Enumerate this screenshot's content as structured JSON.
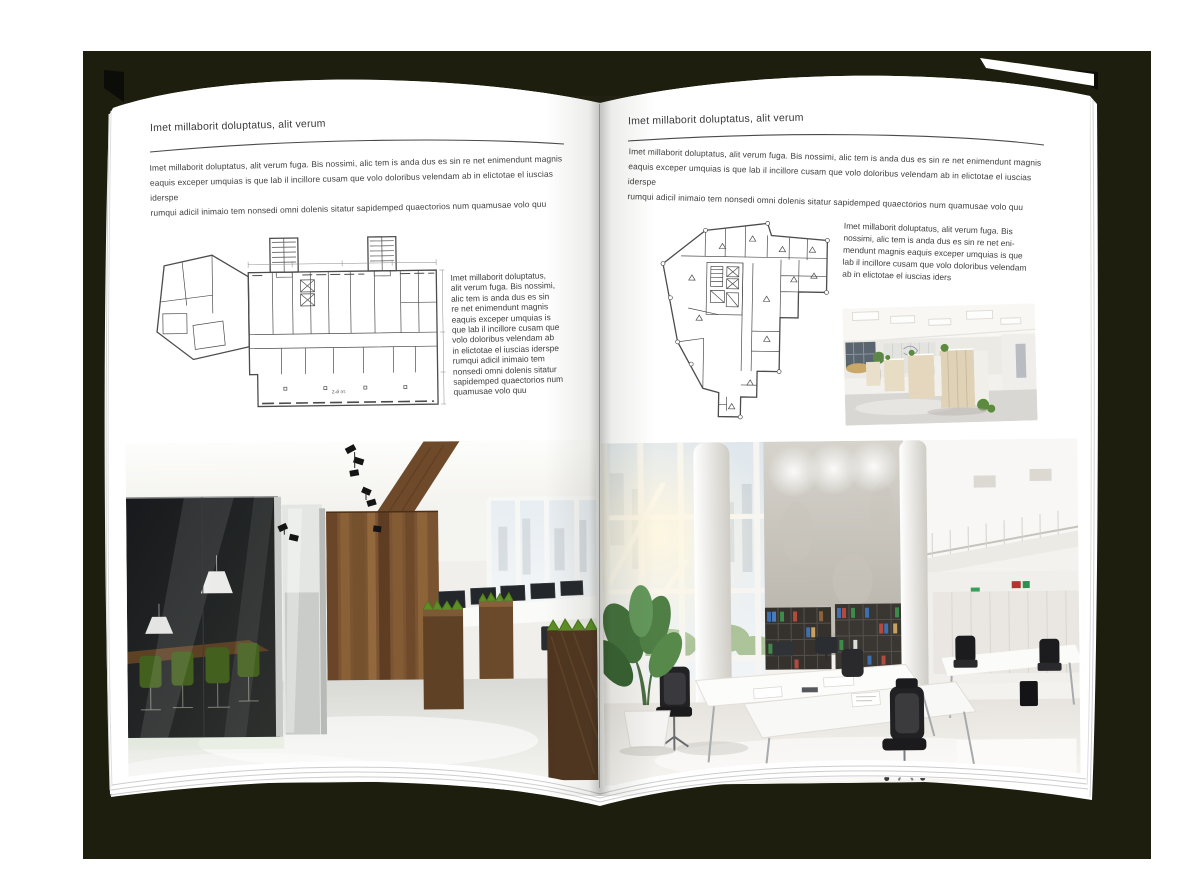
{
  "canvas": {
    "backdrop_color": "#1d1e0e",
    "page_color": "#ffffff"
  },
  "left_page": {
    "header": "Imet millaborit doluptatus, alit verum",
    "intro_lines": [
      "Imet millaborit doluptatus, alit verum fuga. Bis nossimi, alic tem is anda dus es sin re net enimendunt magnis",
      "eaquis exceper umquias is que lab il incillore cusam que volo doloribus velendam ab in elictotae el iuscias iderspe",
      "rumqui adicil inimaio tem nonsedi omni dolenis sitatur sapidemped quaectorios num quamusae volo quu"
    ],
    "side_text_lines": [
      "Imet millaborit doluptatus,",
      "alit verum fuga. Bis nossimi,",
      "alic tem is anda dus es sin",
      "re net enimendunt magnis",
      "eaquis exceper umquias is",
      "que lab il incillore cusam que",
      "volo doloribus velendam ab",
      "in elictotae el iuscias iderspe",
      "rumqui adicil inimaio tem",
      "nonsedi omni dolenis sitatur",
      "sapidemped quaectorios num",
      "quamusae volo quu"
    ],
    "plan_label": "2-й эт."
  },
  "right_page": {
    "header": "Imet millaborit doluptatus, alit verum",
    "intro_lines": [
      "Imet millaborit doluptatus, alit verum fuga. Bis nossimi, alic tem is anda dus es sin re net enimendunt magnis",
      "eaquis exceper umquias is que lab il incillore cusam que volo doloribus velendam ab in elictotae el iuscias iderspe",
      "rumqui adicil inimaio tem nonsedi omni dolenis sitatur sapidemped quaectorios num quamusae volo quu"
    ],
    "side_text_lines": [
      "Imet millaborit doluptatus, alit verum fuga. Bis",
      "nossimi, alic tem is anda dus es sin re net eni-",
      "mendunt magnis eaquis exceper umquias is que",
      "lab il incillore cusam que volo doloribus velendam",
      "ab in elictotae el iuscias iders"
    ]
  }
}
